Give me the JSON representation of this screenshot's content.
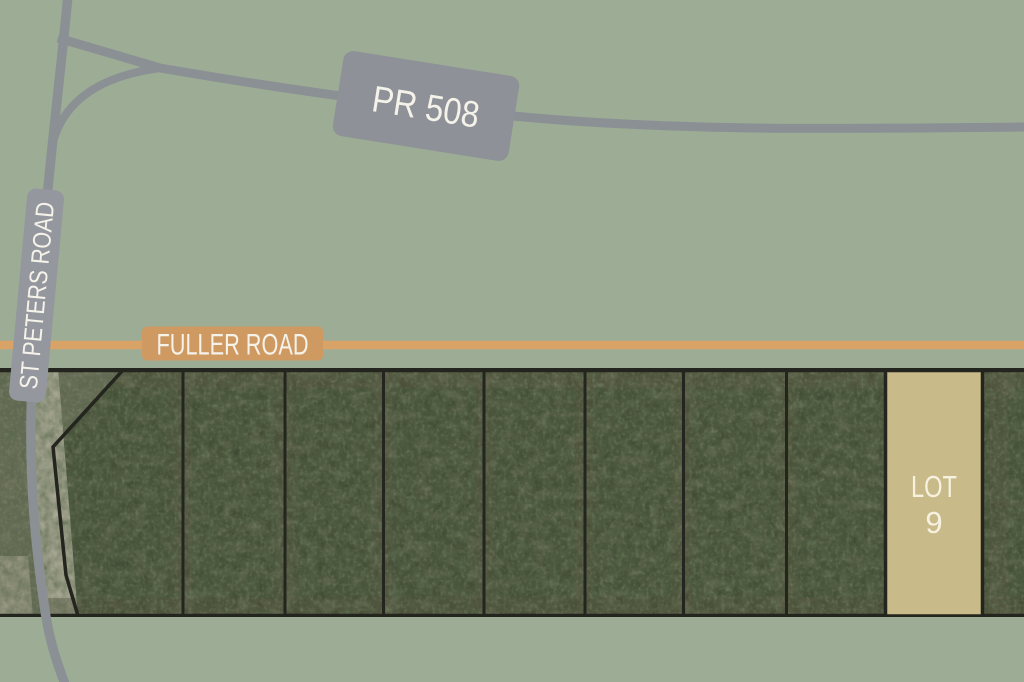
{
  "colors": {
    "background": "#9dac95",
    "road_gray": "#8b9095",
    "road_gray_label": "#8e9298",
    "road_gray_label_light": "#94979d",
    "road_orange": "#d9a267",
    "road_orange_label": "#cf9962",
    "label_text": "#f5f2ea",
    "satellite_base": "#414b34",
    "satellite_clearing": "#656a55",
    "satellite_path": "#b5b2a1",
    "parcel_line": "#24251f",
    "lot_highlight_fill": "#c9ba89",
    "lot_highlight_text": "#f6f2df"
  },
  "roads": {
    "pr508": {
      "label": "PR 508"
    },
    "st_peters": {
      "label": "ST PETERS ROAD"
    },
    "fuller": {
      "label": "FULLER ROAD"
    }
  },
  "lot9": {
    "line1": "LOT",
    "line2": "9"
  }
}
